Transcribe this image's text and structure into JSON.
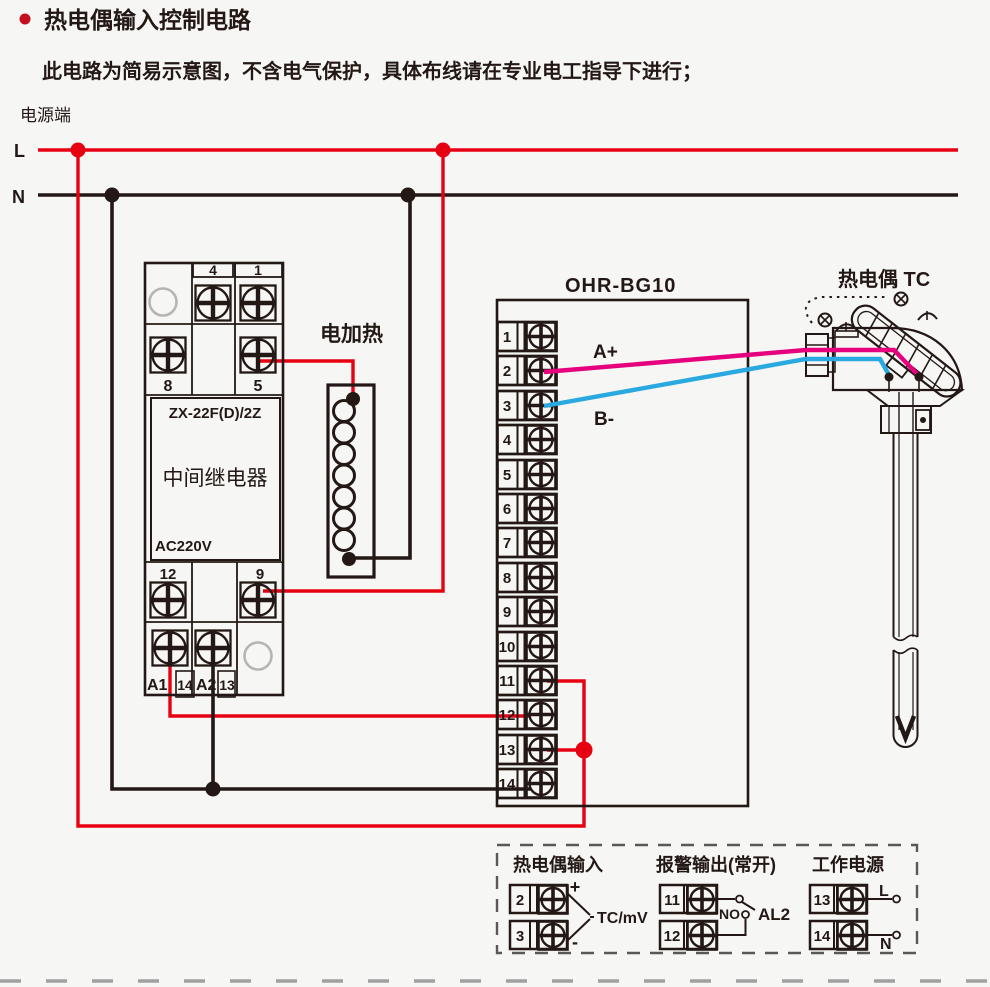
{
  "header": {
    "title": "热电偶输入控制电路",
    "subtitle": "此电路为简易示意图，不含电气保护，具体布线请在专业电工指导下进行；"
  },
  "power": {
    "label": "电源端",
    "l": "L",
    "n": "N"
  },
  "relay": {
    "model": "ZX-22F(D)/2Z",
    "name": "中间继电器",
    "voltage": "AC220V",
    "t4": "4",
    "t1": "1",
    "t8": "8",
    "t5": "5",
    "t12": "12",
    "t9": "9",
    "a1": "A1",
    "n14": "14",
    "a2": "A2",
    "n13": "13"
  },
  "heater": {
    "label": "电加热"
  },
  "instrument": {
    "model": "OHR-BG10",
    "wire_a": "A+",
    "wire_b": "B-",
    "terminals": [
      "1",
      "2",
      "3",
      "4",
      "5",
      "6",
      "7",
      "8",
      "9",
      "10",
      "11",
      "12",
      "13",
      "14"
    ]
  },
  "thermocouple": {
    "label": "热电偶 TC"
  },
  "legend": {
    "tc": {
      "title": "热电偶输入",
      "t2": "2",
      "t3": "3",
      "plus": "+",
      "minus": "-",
      "signal": "TC/mV"
    },
    "alarm": {
      "title": "报警输出(常开)",
      "t11": "11",
      "t12": "12",
      "contact": "NO",
      "name": "AL2"
    },
    "supply": {
      "title": "工作电源",
      "t13": "13",
      "t14": "14",
      "l": "L",
      "n": "N"
    }
  },
  "colors": {
    "line_black": "#231815",
    "live_red": "#e60012",
    "wire_pink": "#e6007e",
    "wire_blue": "#29a9e0",
    "gray": "#b5b5b6",
    "page_dash_gray": "#9fa0a0"
  }
}
